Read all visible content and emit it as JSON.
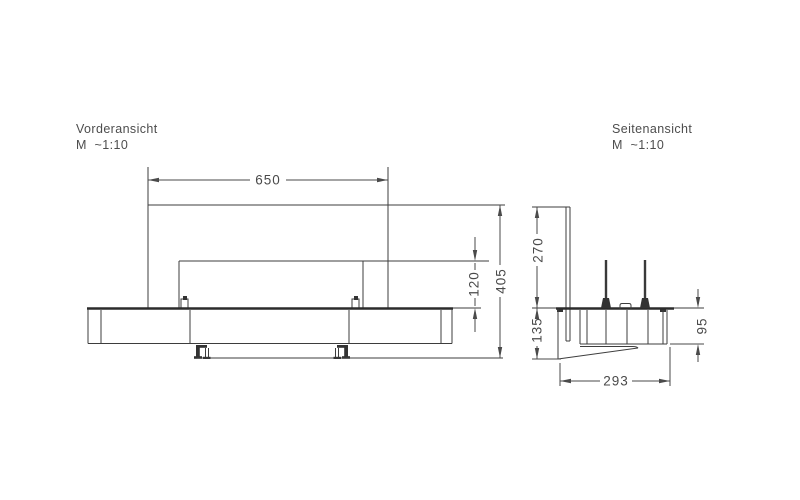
{
  "document": {
    "type": "technical drawing",
    "background": "#ffffff",
    "line_color": "#3d3d3d",
    "text_color": "#4a4a4a"
  },
  "views": {
    "front": {
      "title": "Vorderansicht",
      "scale": "M  ~1:10",
      "dimensions": {
        "width": "650",
        "burner_height": "120",
        "total_height": "405"
      }
    },
    "side": {
      "title": "Seitenansicht",
      "scale": "M  ~1:10",
      "dimensions": {
        "upper_height": "270",
        "lower_height": "135",
        "body_height": "95",
        "depth": "293"
      }
    }
  }
}
